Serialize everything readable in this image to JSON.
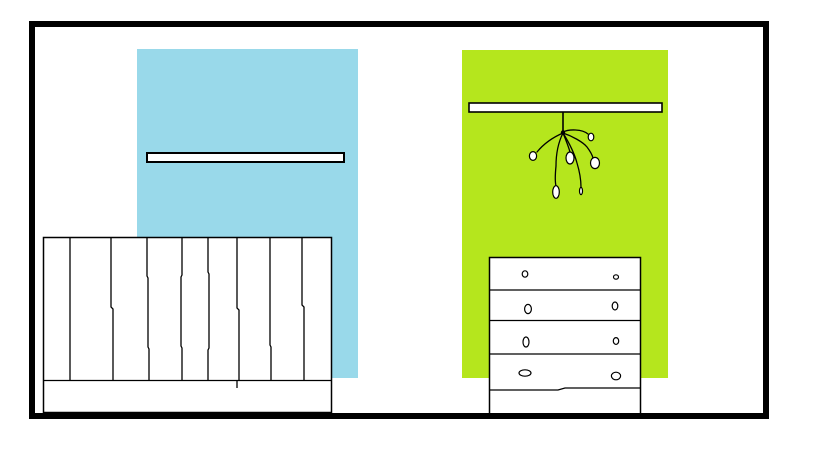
{
  "scene": {
    "canvas": {
      "width": 819,
      "height": 460,
      "background": "#ffffff"
    },
    "ink": {
      "line": "#000000",
      "paper": "#ffffff"
    },
    "frame": {
      "x": 29,
      "y": 21,
      "width": 740,
      "height": 398,
      "thickness": 6,
      "color": "#000000"
    },
    "panels": [
      {
        "name": "blue-wall-panel",
        "x": 137,
        "y": 49,
        "width": 221,
        "height": 329,
        "color": "#99d9ea"
      },
      {
        "name": "green-wall-panel",
        "x": 462,
        "y": 50,
        "width": 206,
        "height": 328,
        "color": "#b5e61d"
      }
    ],
    "shelves": [
      {
        "name": "left-wall-shelf",
        "x": 147,
        "y": 153,
        "width": 197,
        "height": 9,
        "stroke_width": 2
      },
      {
        "name": "right-wall-shelf",
        "x": 469,
        "y": 103,
        "width": 193,
        "height": 9,
        "stroke_width": 1.6
      }
    ],
    "mobile": {
      "stem": {
        "x": 563,
        "y1": 112,
        "y2": 132,
        "stroke_width": 1.6
      },
      "knot": {
        "cx": 563,
        "cy": 132.5,
        "r": 2.2
      },
      "branch_stroke_width": 1.3,
      "branches": [
        "M563,132 C569,129 582,129 588,134",
        "M563,133 C556,136 546,141 537,152",
        "M563,133 C565,138 568,145 570,152",
        "M563,133 C572,136 583,142 587,147 C590,151 592,154 593,158",
        "M563,133 C559,141 556,152 556,166 C555,176 555,182 556,186",
        "M563,133 C568,141 574,152 577,163 C580,173 581,180 581,187"
      ],
      "ornaments": [
        {
          "cx": 591,
          "cy": 137,
          "rx": 2.8,
          "ry": 3.8
        },
        {
          "cx": 533,
          "cy": 156,
          "rx": 3.6,
          "ry": 4.4
        },
        {
          "cx": 570,
          "cy": 158,
          "rx": 4.0,
          "ry": 6.0
        },
        {
          "cx": 595,
          "cy": 163,
          "rx": 4.5,
          "ry": 5.6
        },
        {
          "cx": 556,
          "cy": 192,
          "rx": 3.3,
          "ry": 6.3
        },
        {
          "cx": 581,
          "cy": 191,
          "rx": 1.5,
          "ry": 3.6
        }
      ]
    },
    "fence": {
      "x": 43.5,
      "y": 237.5,
      "width": 288,
      "height": 175,
      "stroke_width": 1.5,
      "rail_y": 380.5,
      "slat_stroke_width": 1.3,
      "slats": [
        "M70,238 L70,380",
        "M111,238 L111,307 L113,309 L113,380",
        "M147,238 L147,276 L148,278 L148,347 L149,349 L149,380",
        "M182,238 L182,275 L181,277 L181,346 L182,348 L182,380",
        "M208,238 L208,272 L209,274 L209,348 L208,350 L208,380",
        "M237,238 L237,308 L239,310 L239,380",
        "M270,238 L270,345 L271,347 L271,380",
        "M302,238 L302,305 L304,307 L304,380"
      ],
      "tick": {
        "x": 237,
        "y1": 381,
        "y2": 388
      }
    },
    "dresser": {
      "x": 489.5,
      "y": 257.5,
      "width": 151,
      "height": 157,
      "stroke_width": 1.5,
      "divider_ys": [
        290,
        320.5,
        354
      ],
      "divider_stroke_width": 1.3,
      "wavy_divider": "M490,390 L558,390 L565,388 L640,388",
      "knob_stroke_width": 1.2,
      "knobs": [
        {
          "cx": 525,
          "cy": 274,
          "rx": 2.8,
          "ry": 3.2
        },
        {
          "cx": 616,
          "cy": 277,
          "rx": 2.5,
          "ry": 2.2
        },
        {
          "cx": 528,
          "cy": 309,
          "rx": 3.4,
          "ry": 4.6
        },
        {
          "cx": 615,
          "cy": 306,
          "rx": 2.8,
          "ry": 4.0
        },
        {
          "cx": 526,
          "cy": 342,
          "rx": 3.0,
          "ry": 5.0
        },
        {
          "cx": 616,
          "cy": 341,
          "rx": 2.7,
          "ry": 3.4
        },
        {
          "cx": 525,
          "cy": 373,
          "rx": 6.0,
          "ry": 3.2
        },
        {
          "cx": 616,
          "cy": 376,
          "rx": 4.6,
          "ry": 3.8
        }
      ]
    }
  }
}
